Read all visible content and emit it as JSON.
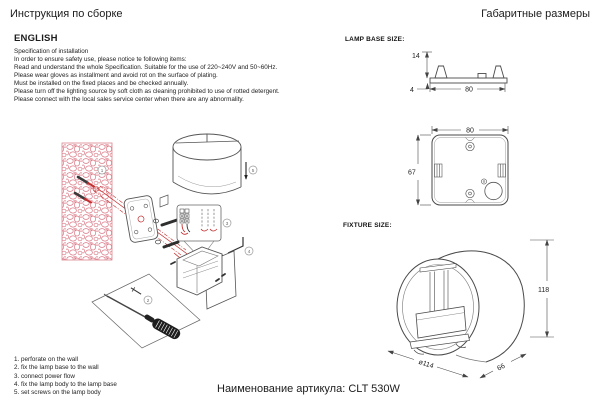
{
  "page": {
    "title_left": "Инструкция по сборке",
    "title_right": "Габаритные размеры",
    "article": "Наименование артикула: CLT 530W"
  },
  "instructions": {
    "heading": "ENGLISH",
    "lines": [
      "Specification of installation",
      "In order to ensure safety use, please notice te following items:",
      "Read and understand the whole Specification. Suitable for the use of 220~240V and 50~60Hz.",
      "Please wear gloves as installment and avoid rot on the surface of plating.",
      "Must be installed on the fixed places and be checked annually.",
      "Please turn off the lighting source by soft cloth as cleaning prohibited to use of rotted detergent.",
      "Please connect with the local sales service center when there are any abnormality."
    ]
  },
  "assembly_steps": [
    "1. perforate on the wall",
    "2. fix the lamp base to the wall",
    "3. connect power flow",
    "4. fix the lamp body to the lamp base",
    "5. set screws on the lamp body"
  ],
  "diagram_markers": {
    "m1": "1",
    "m2": "2",
    "m3": "3",
    "m4": "4",
    "m5": "5"
  },
  "dimensions": {
    "lamp_base_section_label": "LAMP BASE SIZE:",
    "fixture_section_label": "FIXTURE SIZE:",
    "base_side_view": {
      "clip_height": "14",
      "plate_thickness": "4",
      "width": "80"
    },
    "base_front_view": {
      "width": "80",
      "height": "67"
    },
    "fixture_view": {
      "height": "118",
      "diameter": "ø114",
      "depth": "66"
    }
  },
  "colors": {
    "ink": "#1c1c1c",
    "line": "#4a4a4a",
    "wall_pink": "#d97583",
    "accent_red": "#c43030"
  }
}
